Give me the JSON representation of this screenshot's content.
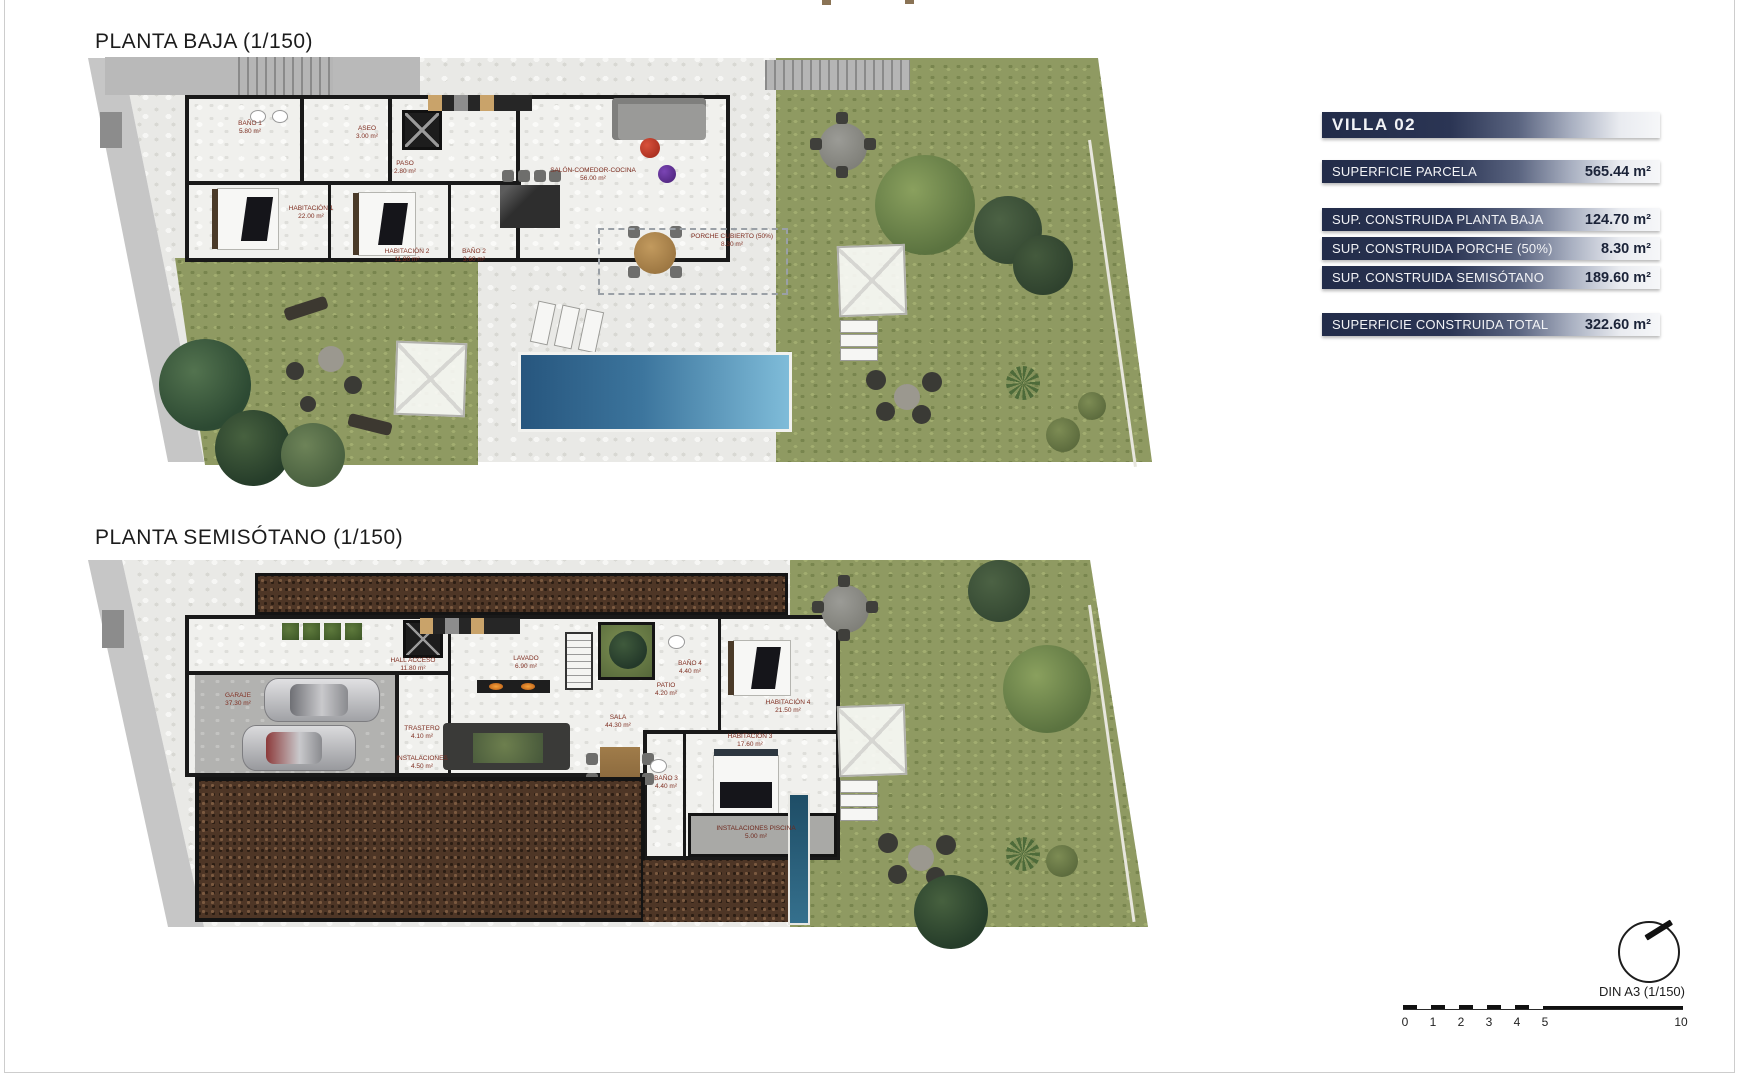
{
  "plan_baja": {
    "title": "PLANTA BAJA (1/150)",
    "rooms": [
      {
        "name": "BAÑO 1",
        "area": "5.80 m²"
      },
      {
        "name": "ASEO",
        "area": "3.00 m²"
      },
      {
        "name": "PASO",
        "area": "2.80 m²"
      },
      {
        "name": "HABITACIÓN 1",
        "area": "22.00 m²"
      },
      {
        "name": "HABITACIÓN 2",
        "area": "11.80 m²"
      },
      {
        "name": "BAÑO 2",
        "area": "3.60 m²"
      },
      {
        "name": "SALÓN-COMEDOR-COCINA",
        "area": "56.00 m²"
      },
      {
        "name": "PORCHE CUBIERTO (50%)",
        "area": "8.30 m²"
      }
    ]
  },
  "plan_semisotano": {
    "title": "PLANTA SEMISÓTANO (1/150)",
    "rooms": [
      {
        "name": "HALL ACCESO",
        "area": "11.80 m²"
      },
      {
        "name": "GARAJE",
        "area": "37.30 m²"
      },
      {
        "name": "TRASTERO",
        "area": "4.10 m²"
      },
      {
        "name": "INSTALACIONES",
        "area": "4.50 m²"
      },
      {
        "name": "LAVADO",
        "area": "6.90 m²"
      },
      {
        "name": "PATIO",
        "area": "4.20 m²"
      },
      {
        "name": "BAÑO 4",
        "area": "4.40 m²"
      },
      {
        "name": "HABITACIÓN 4",
        "area": "21.50 m²"
      },
      {
        "name": "SALA",
        "area": "44.30 m²"
      },
      {
        "name": "HABITACIÓN 3",
        "area": "17.60 m²"
      },
      {
        "name": "BAÑO 3",
        "area": "4.40 m²"
      },
      {
        "name": "INSTALACIONES PISCINA",
        "area": "5.00 m²"
      }
    ]
  },
  "info_panel": {
    "title": "VILLA 02",
    "rows": [
      {
        "label": "SUPERFICIE PARCELA",
        "value": "565.44 m²"
      },
      {
        "label": "SUP. CONSTRUIDA PLANTA BAJA",
        "value": "124.70 m²"
      },
      {
        "label": "SUP. CONSTRUIDA PORCHE (50%)",
        "value": "8.30 m²"
      },
      {
        "label": "SUP. CONSTRUIDA SEMISÓTANO",
        "value": "189.60 m²"
      },
      {
        "label": "SUPERFICIE CONSTRUIDA TOTAL",
        "value": "322.60 m²"
      }
    ],
    "colors": {
      "bar_dark": "#222c49",
      "bar_light": "#f6f7f9",
      "value_text": "#1b2338"
    }
  },
  "footer": {
    "format_label": "DIN A3 (1/150)",
    "scale_ticks": [
      "0",
      "1",
      "2",
      "3",
      "4",
      "5",
      "10"
    ]
  },
  "palette": {
    "room_label_red": "#7e2d20",
    "pool_blue_dark": "#27567e",
    "pool_blue_light": "#7fbcd9",
    "garden_green": "#8f9a62",
    "gravel_brown": "#4e3626"
  }
}
